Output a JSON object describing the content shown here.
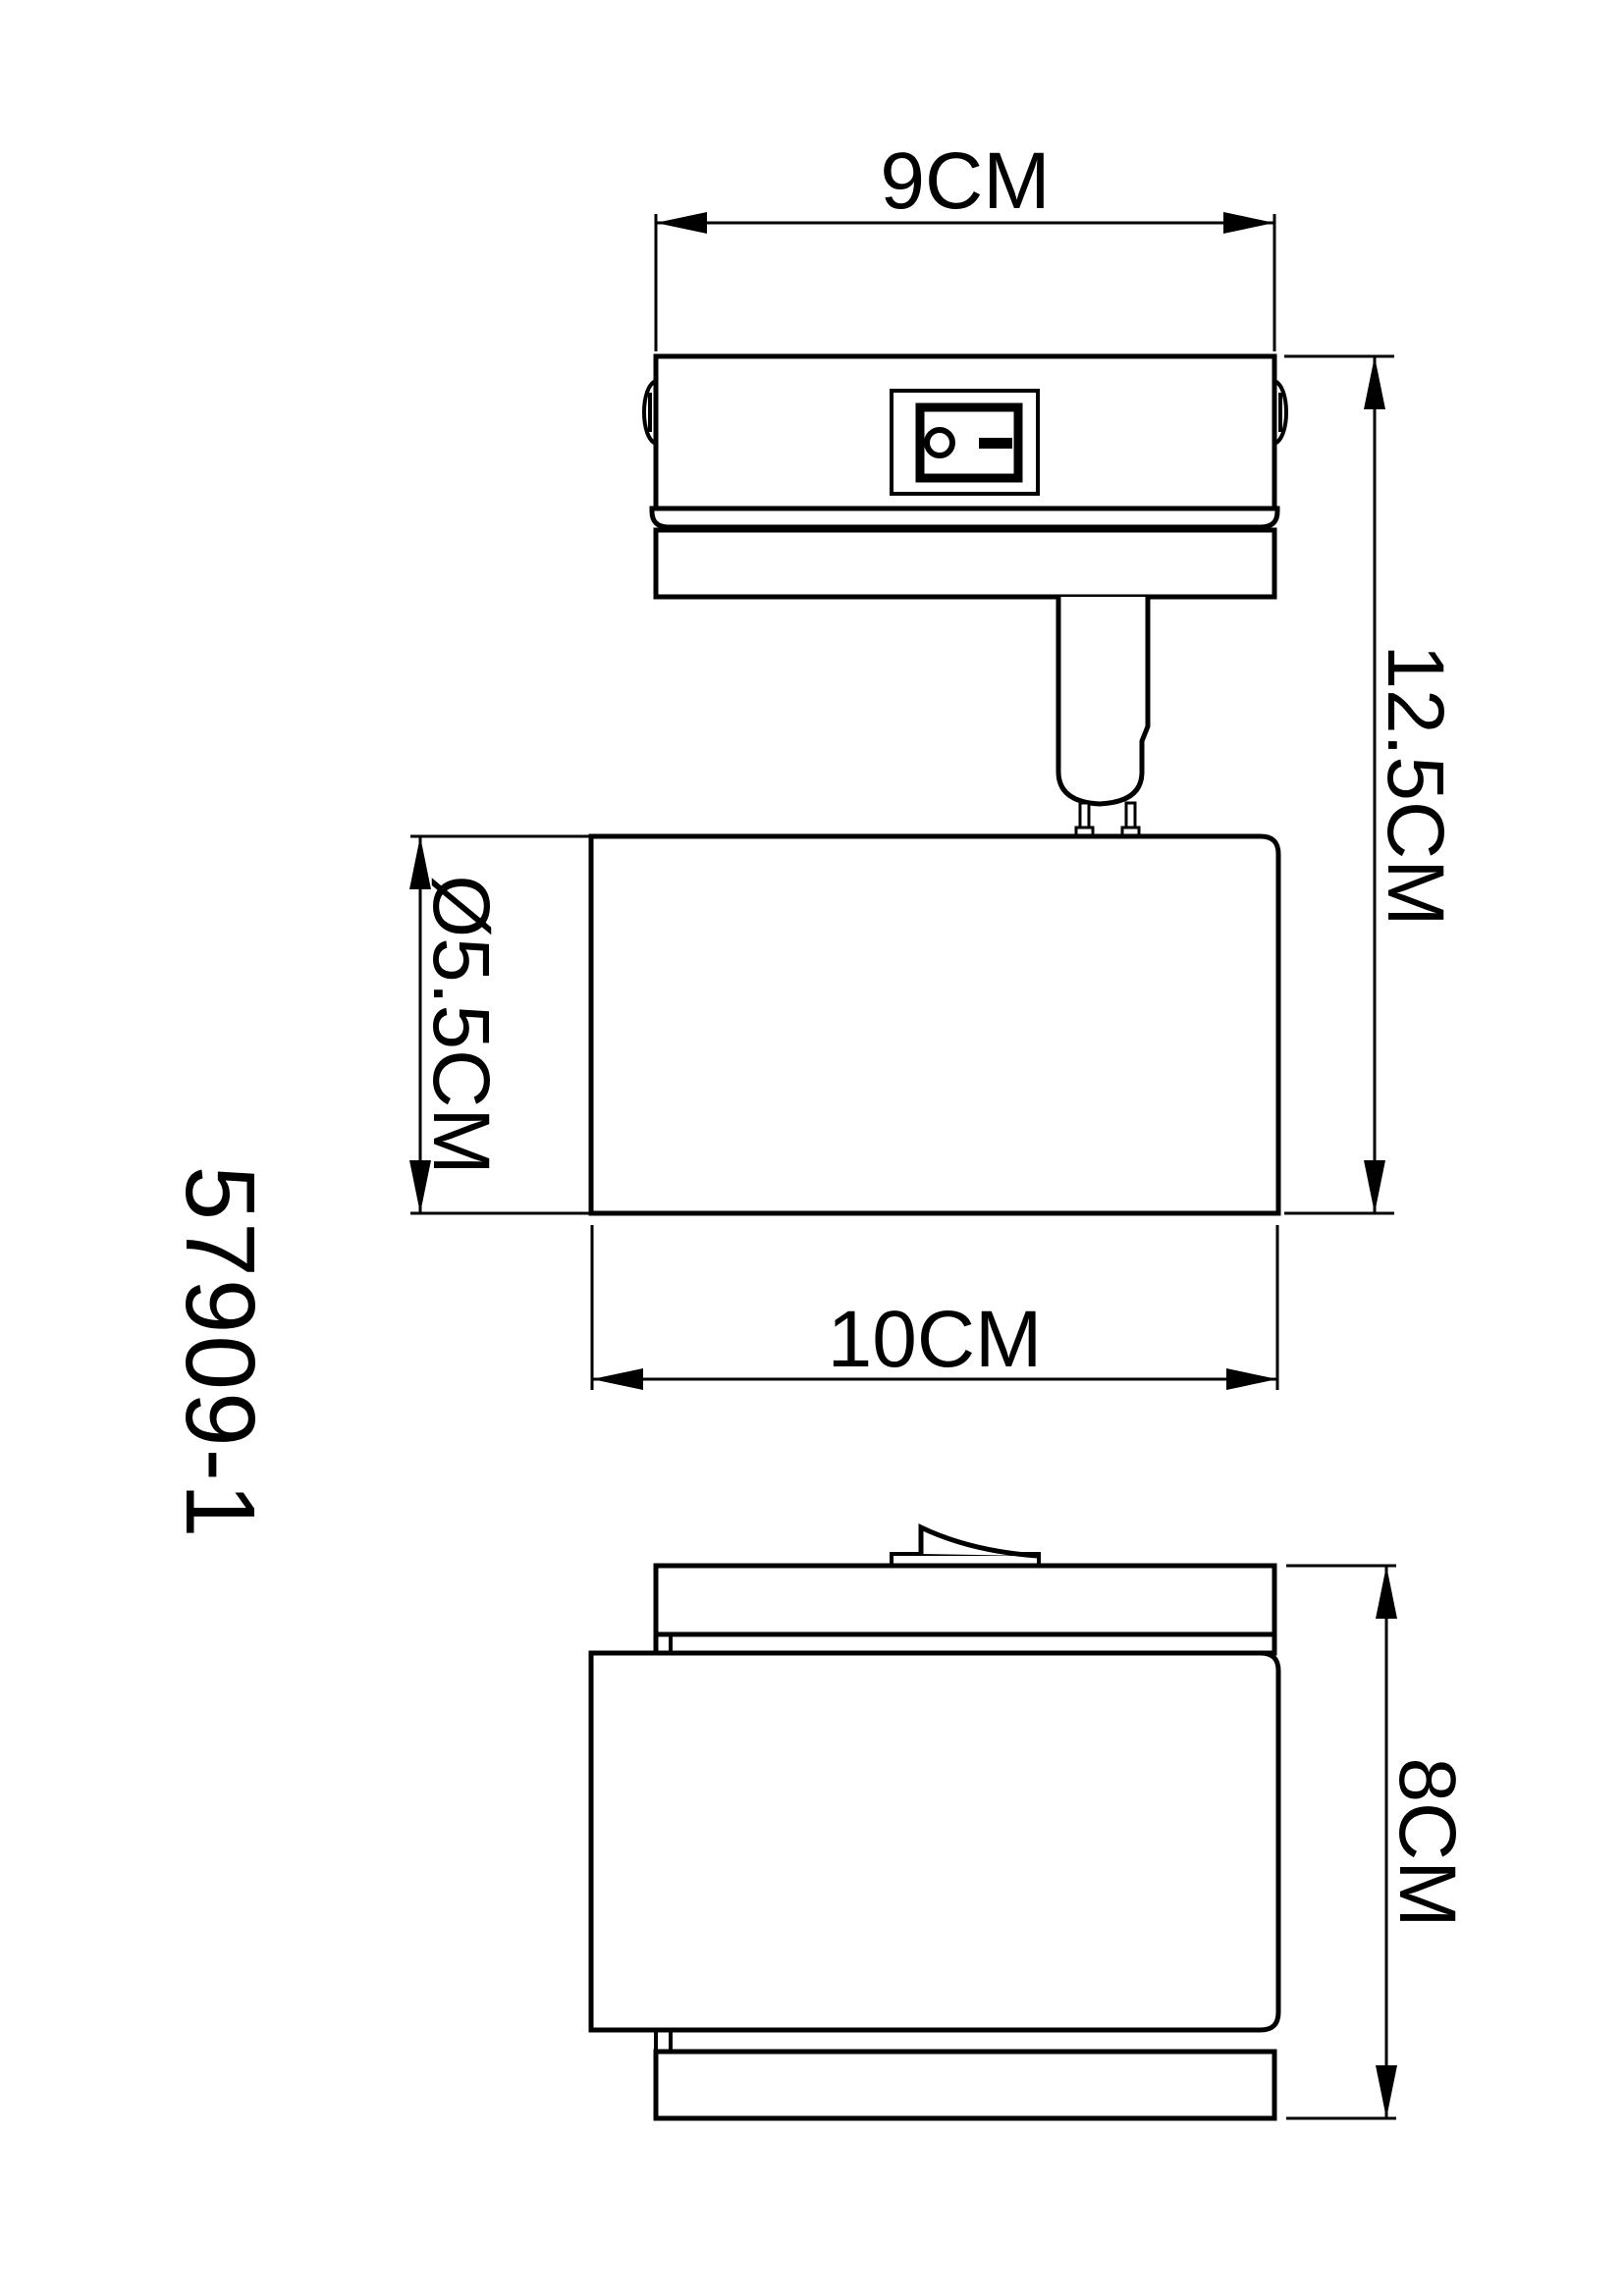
{
  "drawing": {
    "background_color": "#ffffff",
    "line_color": "#000000",
    "model_number": "57909-1",
    "dimensions": {
      "top_width": "9CM",
      "overall_height": "12.5CM",
      "body_diameter": "Ø5.5CM",
      "body_width": "10CM",
      "side_height": "8CM"
    }
  }
}
